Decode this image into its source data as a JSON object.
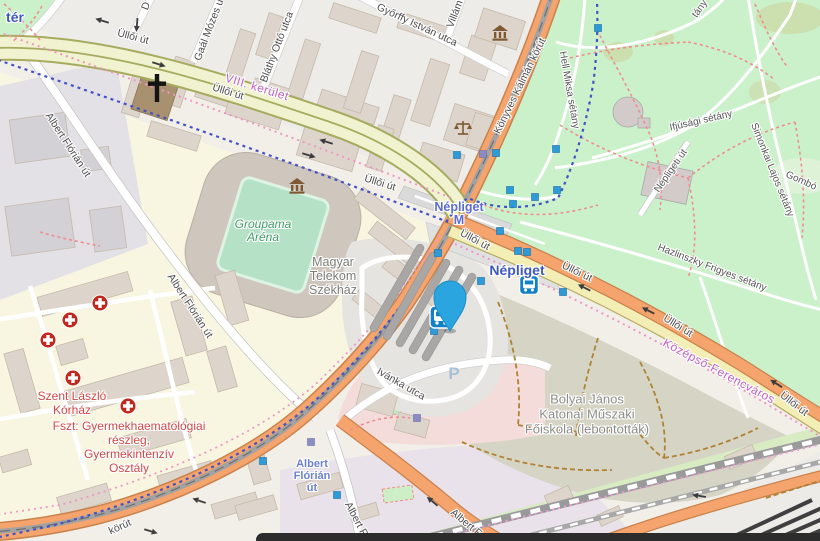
{
  "regions": {
    "district_top": "VIII. kerület",
    "district_bottom": "Középső-Ferencváros",
    "ter_fragment": "tér"
  },
  "streets": [
    {
      "text": "Üllői út"
    },
    {
      "text": "Üllői út"
    },
    {
      "text": "Üllői út"
    },
    {
      "text": "Üllői út"
    },
    {
      "text": "Üllői út"
    },
    {
      "text": "Üllői út"
    },
    {
      "text": "Üllői út"
    },
    {
      "text": "Könyves Kálmán körút"
    },
    {
      "text": "körút"
    },
    {
      "text": "Albert Flórián út"
    },
    {
      "text": "Albert Flórián út"
    },
    {
      "text": "Albert F"
    },
    {
      "text": "Albert F"
    },
    {
      "text": "Gaál Mózes u"
    },
    {
      "text": "Bláthy Ottó utca"
    },
    {
      "text": "Győrffy István utca"
    },
    {
      "text": "Villám"
    },
    {
      "text": "Hell Miksa sétány"
    },
    {
      "text": "Ifjúsági sétány"
    },
    {
      "text": "Simonkai Lajos sétány"
    },
    {
      "text": "Népligeti út"
    },
    {
      "text": "Hazlinszky Frigyes sétány"
    },
    {
      "text": "Gombó"
    },
    {
      "text": "Ivánka utca"
    },
    {
      "text": "tány"
    },
    {
      "text": "D"
    }
  ],
  "places": {
    "groupama": {
      "lines": [
        "Groupama",
        "Aréna"
      ]
    },
    "telekom": {
      "lines": [
        "Magyar",
        "Telekom",
        "Székház"
      ]
    },
    "bolyai": {
      "lines": [
        "Bolyai János",
        "Katonai Műszaki",
        "Főiskola (lebontották)"
      ]
    },
    "hospital_name": {
      "lines": [
        "Szent László",
        "Kórház"
      ]
    },
    "hospital_dept": {
      "lines": [
        "Fszt: Gyermekhaematológiai",
        "részleg,",
        "Gyermekintenzív",
        "Osztály"
      ]
    }
  },
  "transit": {
    "bus_station_label": "Népliget",
    "metro_label_lines": [
      "Népliget",
      "M"
    ],
    "stop_label_lines": [
      "Albert",
      "Flórián",
      "út"
    ],
    "parking_label": "P"
  },
  "icons": {
    "pin": "location-pin-icon",
    "bus_station": "bus-icon",
    "hospital": "hospital-cross-icon",
    "museum": "museum-icon",
    "courthouse": "scales-of-justice-icon",
    "church": "christian-cross-icon",
    "parking": "parking-icon",
    "transit_stop": "transit-stop-square-icon",
    "one_way": "one-way-arrow-icon"
  },
  "colors": {
    "pin_blue": "#2aa5df",
    "transit_stop_blue": "#2e9ad6",
    "bus_icon_blue": "#1180c6",
    "station_label_blue": "#3d58c0",
    "stop_label_blue": "#6b80cf",
    "hospital_red": "#d14747",
    "district_purple": "#bf5fbf",
    "leisure_green": "#3e9c66",
    "park_green": "#cbf1cb",
    "road_orange": "#f4a46c",
    "trunk_yellow": "#f0f2d0",
    "secondary_yellow": "#f2eeb6",
    "residential_yellow": "#f8f6e1",
    "brownfield_olive": "#d6d5c5",
    "hospital_area_pink": "#f3dcda",
    "route_blue": "#4453c4",
    "route_pink": "#ee96c6",
    "path_red": "#ef8e8e",
    "path_brown": "#b08236"
  }
}
